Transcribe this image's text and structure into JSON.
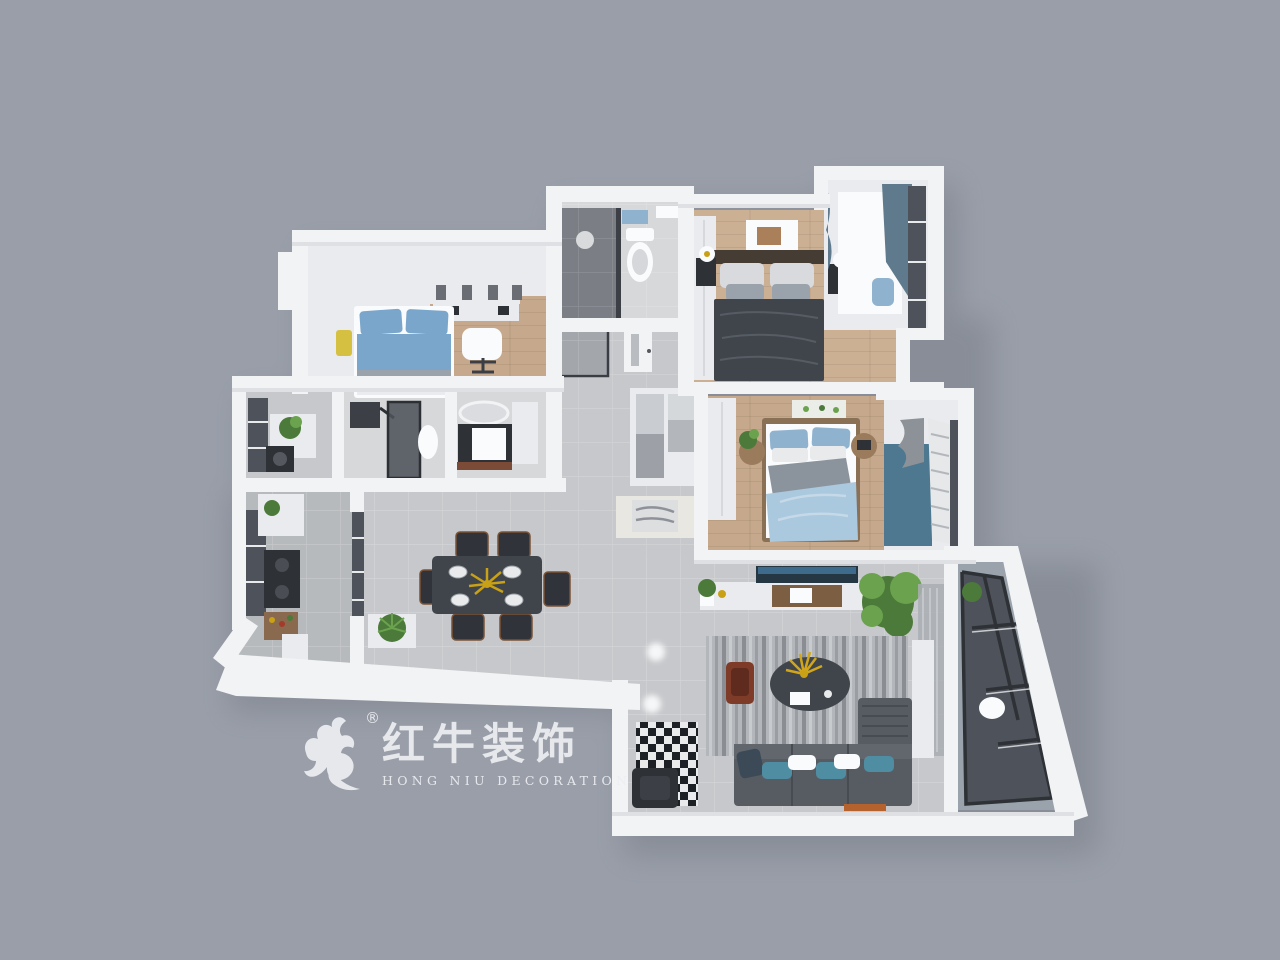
{
  "watermark": {
    "brand_cn": "红牛装饰",
    "brand_en": "HONG NIU DECORATION",
    "registered_mark": "®"
  },
  "palette": {
    "bg": "#999ea9",
    "wall": "#f2f3f5",
    "soft_white": "#e9ebee",
    "pure_white": "#fafbfc",
    "wood_floor": "#c6a98c",
    "wood_floor_light": "#ccb094",
    "tile_floor": "#c6c8cb",
    "tile_dark": "#b7babd",
    "bath_tile": "#d6d8da",
    "dark_furniture": "#2e3236",
    "dark_bed": "#40454c",
    "shower_gray": "#7b7f85",
    "glass_dark": "#4e525a",
    "blue_bed": "#7ba6cc",
    "light_blue_bedding": "#aac8de",
    "blue_pillow": "#8fb2cf",
    "teal_accent": "#4d7890",
    "teal_pillow": "#4f8da3",
    "curtain_teal": "#5e7a8c",
    "sofa_gray": "#575c62",
    "rug_gray": "#b3b6ba",
    "plant_green": "#4c7a3a",
    "plant_green_light": "#6ba24e",
    "gold_accent": "#c9a117",
    "wood_brown": "#7c5e42",
    "red_chair": "#7e3b28",
    "yellow_pillow": "#d6c041",
    "mid_gray": "#9aa3ac",
    "watermark": "#eceef2"
  }
}
